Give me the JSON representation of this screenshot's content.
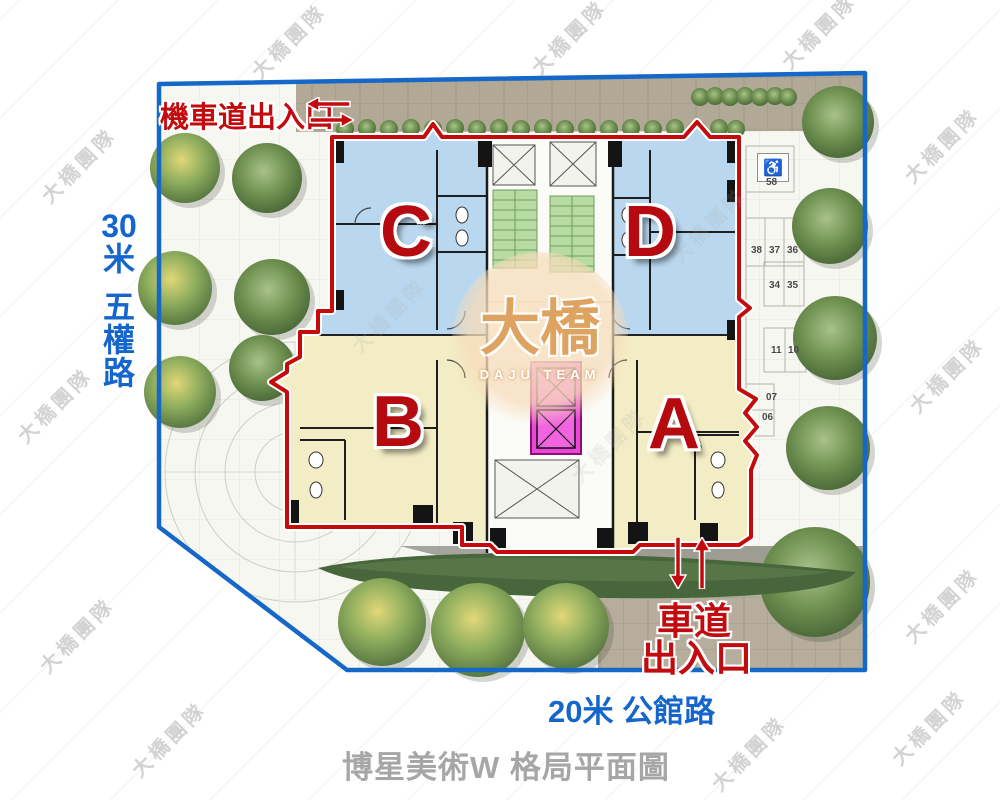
{
  "title": "博星美術W 格局平面圖",
  "roads": {
    "left_chars": [
      "30",
      "米",
      "五",
      "權",
      "路"
    ],
    "bottom": "20米 公館路"
  },
  "entrances": {
    "motorcycle": "機車道出入口",
    "car_line1": "車道",
    "car_line2": "出入口"
  },
  "units": {
    "a": "A",
    "b": "B",
    "c": "C",
    "d": "D"
  },
  "parking": {
    "spaces": [
      "58",
      "38",
      "37",
      "36",
      "34",
      "35",
      "11",
      "10",
      "07",
      "06"
    ]
  },
  "watermark": {
    "logo": "大橋",
    "team": "DAJU TEAM",
    "pattern": "大橋團隊"
  },
  "colors": {
    "boundary_blue": "#1668c8",
    "building_outline_red": "#c40a0a",
    "unit_upper_fill": "#b9d7ee",
    "unit_lower_fill": "#f2edc4",
    "elevator_magenta": "#ea48d4",
    "stair_green": "#b7dba2",
    "road_text_blue": "#1465cc",
    "label_red": "#c20b0e",
    "title_gray": "#a6a6a6"
  }
}
